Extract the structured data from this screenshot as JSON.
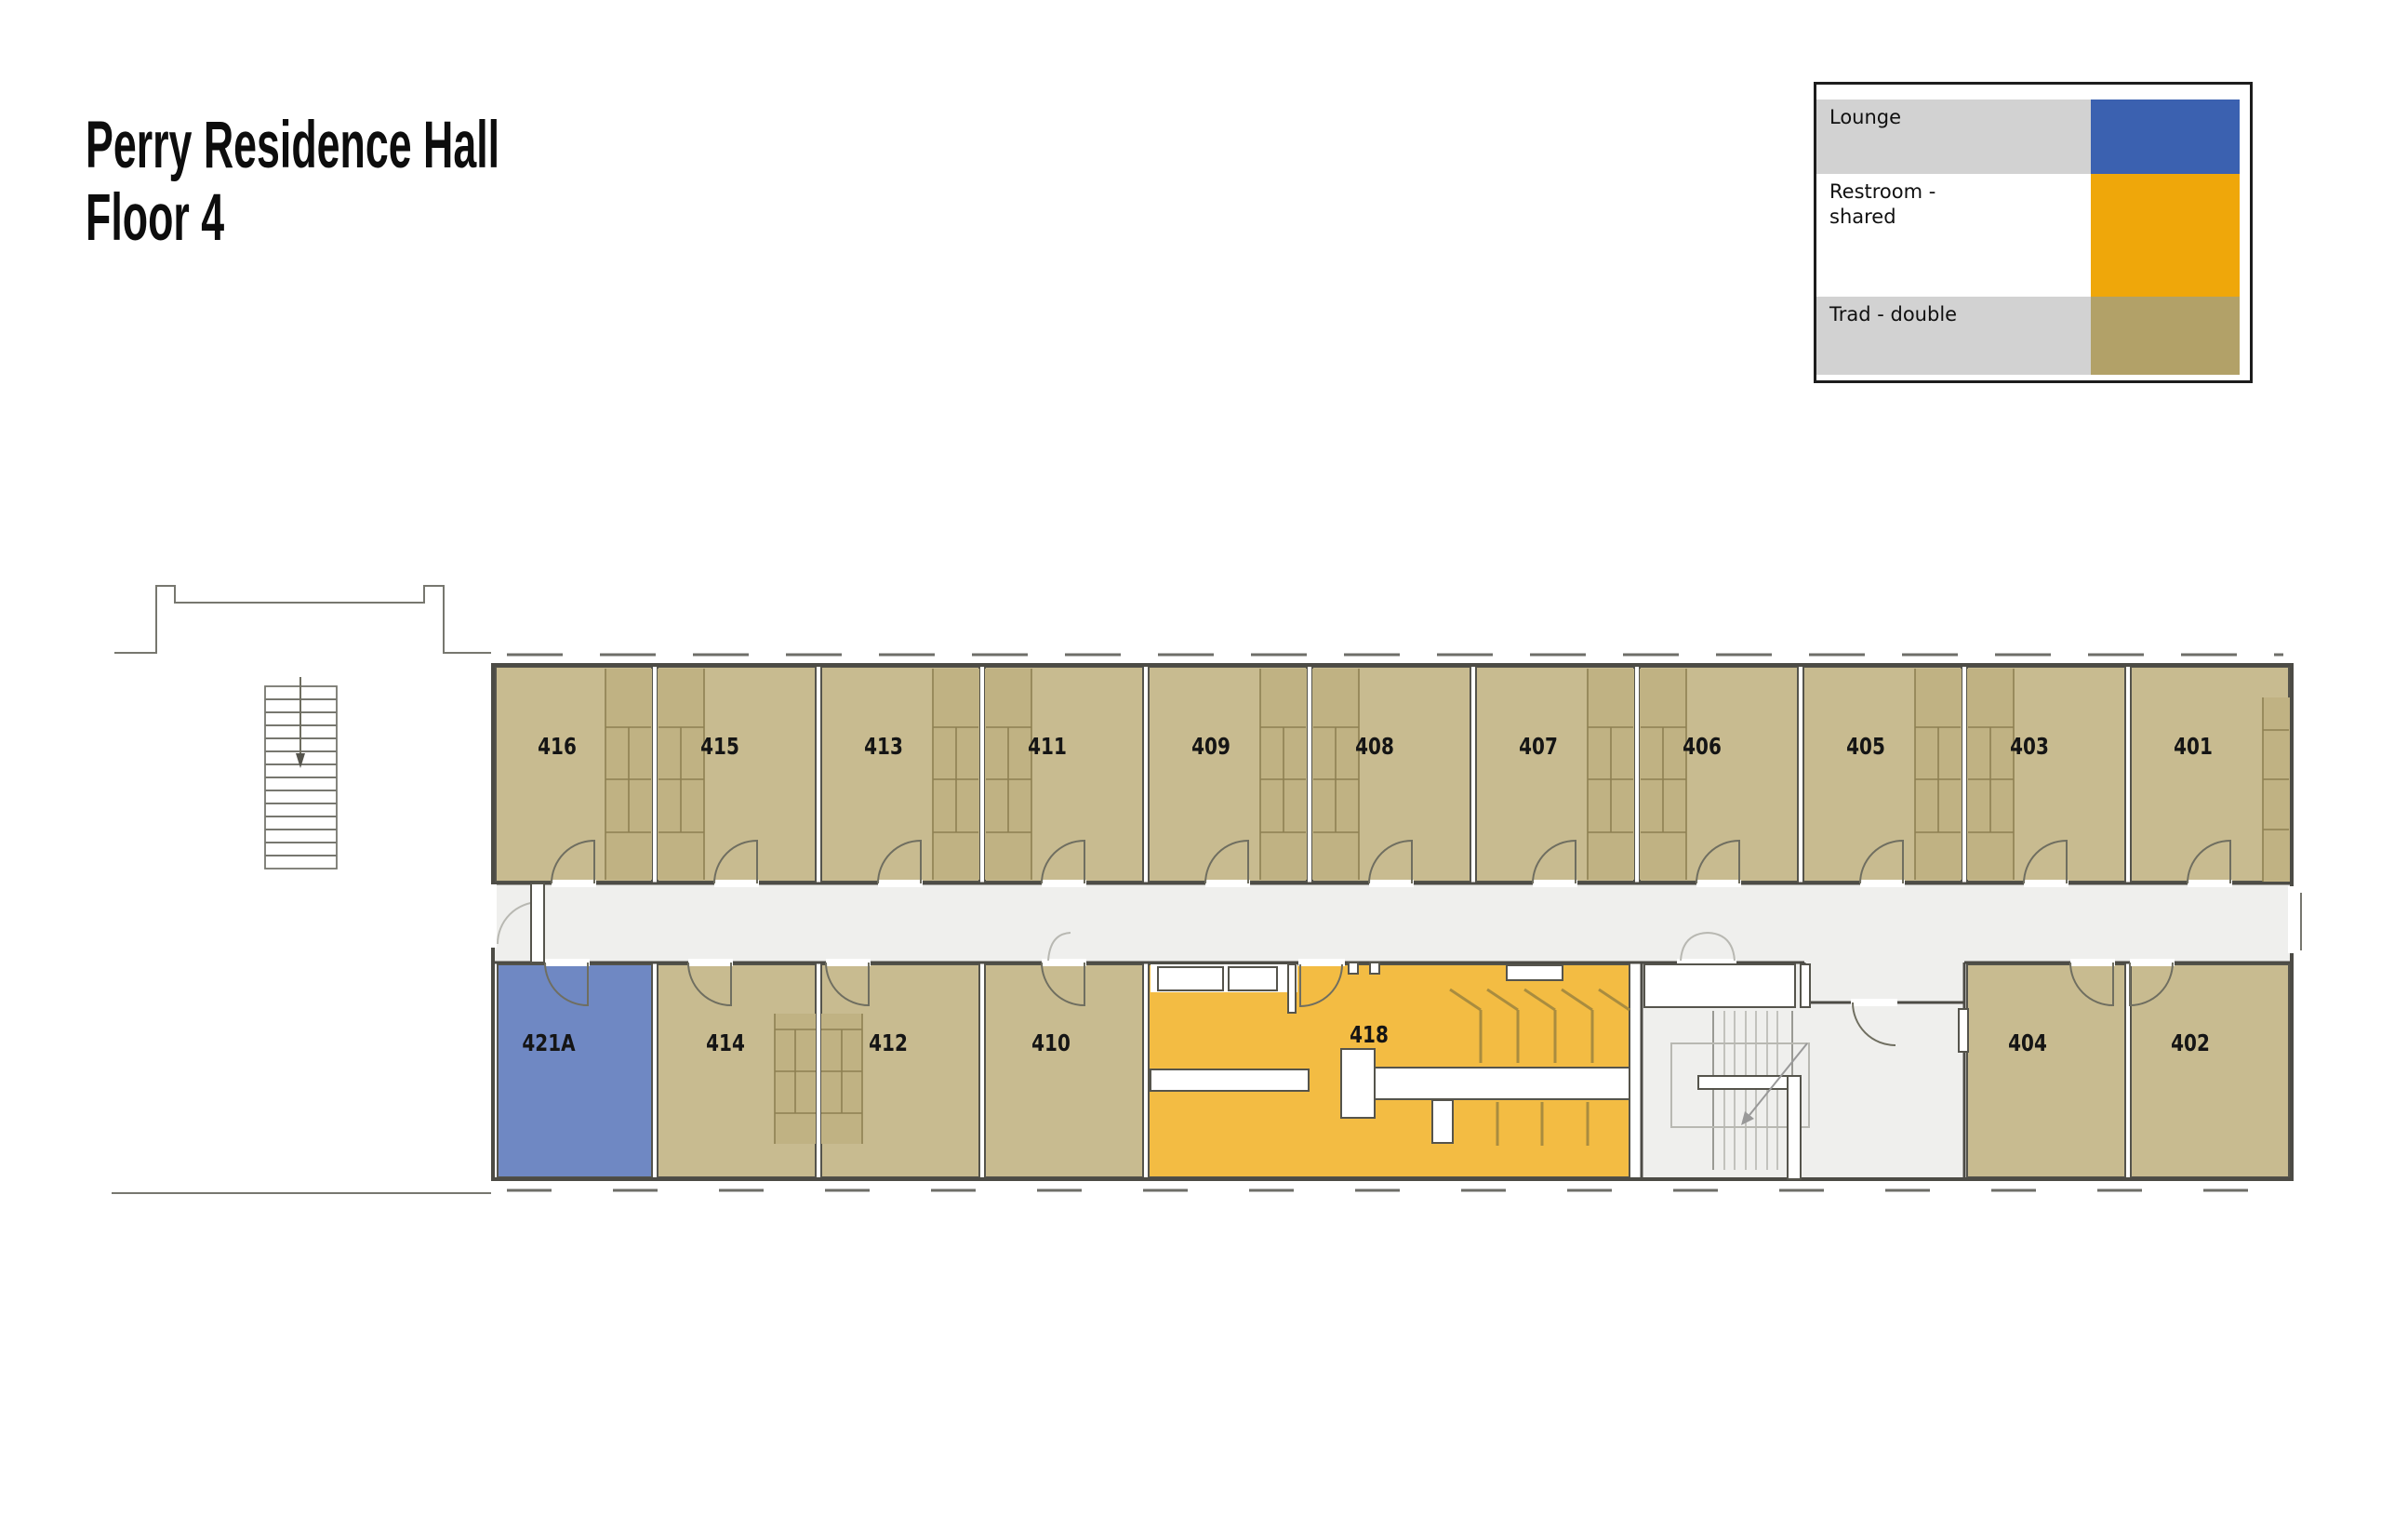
{
  "title": {
    "line1": "Perry Residence Hall",
    "line2": "Floor 4"
  },
  "legend": {
    "items": [
      {
        "label": "Lounge",
        "color": "#3b61b0"
      },
      {
        "label": "Restroom -\nshared",
        "color": "#efa70a"
      },
      {
        "label": "Trad - double",
        "color": "#b2a168"
      }
    ]
  },
  "rooms": {
    "top": [
      {
        "number": "416",
        "type": "Trad - double"
      },
      {
        "number": "415",
        "type": "Trad - double"
      },
      {
        "number": "413",
        "type": "Trad - double"
      },
      {
        "number": "411",
        "type": "Trad - double"
      },
      {
        "number": "409",
        "type": "Trad - double"
      },
      {
        "number": "408",
        "type": "Trad - double"
      },
      {
        "number": "407",
        "type": "Trad - double"
      },
      {
        "number": "406",
        "type": "Trad - double"
      },
      {
        "number": "405",
        "type": "Trad - double"
      },
      {
        "number": "403",
        "type": "Trad - double"
      },
      {
        "number": "401",
        "type": "Trad - double"
      }
    ],
    "bottom": [
      {
        "number": "421A",
        "type": "Lounge"
      },
      {
        "number": "414",
        "type": "Trad - double"
      },
      {
        "number": "412",
        "type": "Trad - double"
      },
      {
        "number": "410",
        "type": "Trad - double"
      },
      {
        "number": "418",
        "type": "Restroom - shared"
      },
      {
        "number": "404",
        "type": "Trad - double"
      },
      {
        "number": "402",
        "type": "Trad - double"
      }
    ]
  },
  "colors": {
    "trad_double_room": "#c8bb90",
    "lounge_room": "#6f88c3",
    "restroom_room": "#f3bc43",
    "corridor": "#efefed",
    "wall": "#4c4b45",
    "legend_label_gray": "#d2d2d2",
    "legend_lounge": "#3b61b0",
    "legend_restroom": "#efa70a",
    "legend_trad": "#b2a168"
  }
}
